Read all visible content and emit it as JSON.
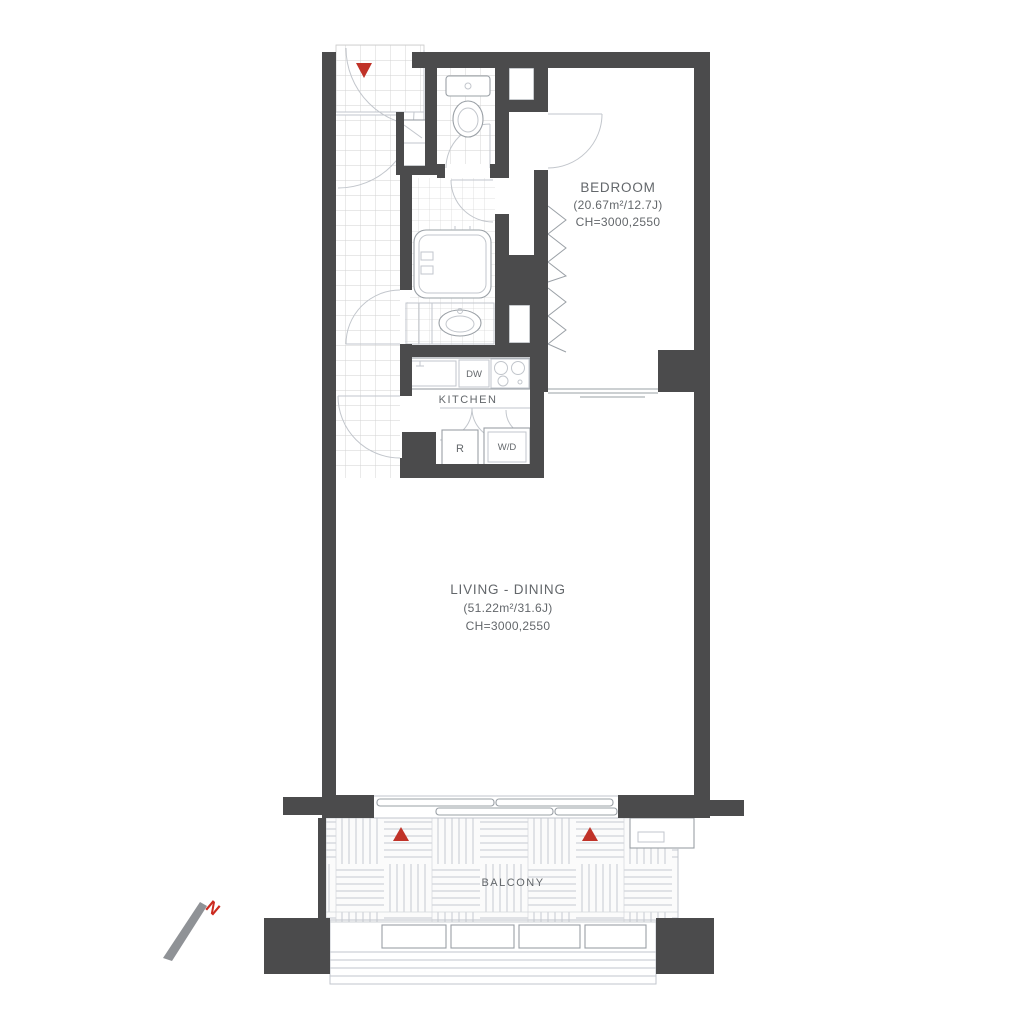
{
  "rooms": {
    "bedroom": {
      "name": "BEDROOM",
      "area": "(20.67m²/12.7J)",
      "ceiling_height": "CH=3000,2550"
    },
    "living_dining": {
      "name": "LIVING - DINING",
      "area": "(51.22m²/31.6J)",
      "ceiling_height": "CH=3000,2550"
    },
    "kitchen": {
      "name": "KITCHEN"
    },
    "balcony": {
      "name": "BALCONY"
    }
  },
  "appliances": {
    "dishwasher": "DW",
    "refrigerator": "R",
    "washer_dryer": "W/D"
  },
  "compass": {
    "north_label": "N"
  },
  "colors": {
    "wall": "#4b4b4c",
    "line": "#9aa0a6",
    "line_soft": "#c2c6cc",
    "tile": "#d2d2d2",
    "text": "#63676b",
    "marker_red": "#c03228",
    "north_red": "#cc2a1f"
  }
}
